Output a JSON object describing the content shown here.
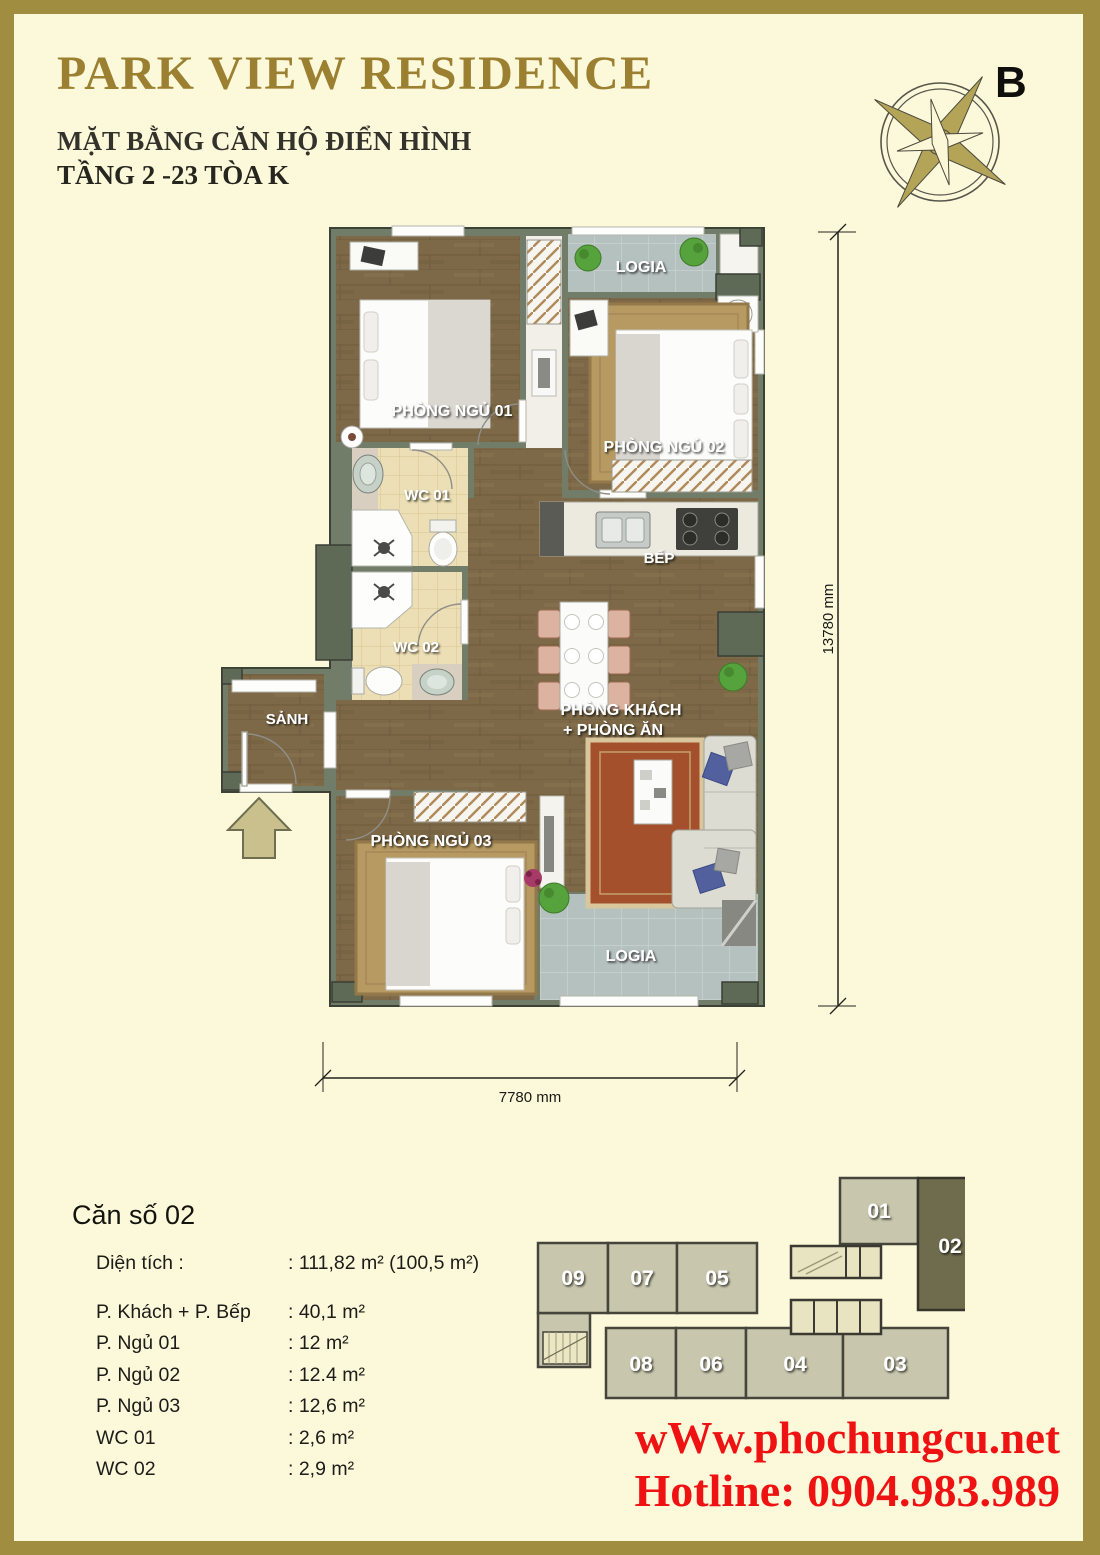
{
  "header": {
    "title": "PARK VIEW RESIDENCE",
    "subtitle1": "MẶT BẰNG CĂN HỘ ĐIỂN HÌNH",
    "subtitle2": "TẦNG 2 -23 TÒA K"
  },
  "compass": {
    "label": "B"
  },
  "plan": {
    "labels": {
      "bedroom1": "PHÒNG NGỦ 01",
      "logia_top": "LOGIA",
      "bedroom2": "PHÒNG NGỦ 02",
      "wc1": "WC 01",
      "kitchen": "BẾP",
      "wc2": "WC 02",
      "hall": "SẢNH",
      "living_line1": "PHÒNG KHÁCH",
      "living_line2": "+ PHÒNG ĂN",
      "bedroom3": "PHÒNG NGỦ 03",
      "logia_bottom": "LOGIA"
    },
    "dimensions": {
      "height": "13780 mm",
      "width": "7780 mm"
    }
  },
  "unit_info": {
    "title": "Căn số 02",
    "rows": [
      {
        "label": "Diện tích :",
        "value": ": 111,82 m² (100,5 m²)"
      },
      {
        "label": "P. Khách + P. Bếp",
        "value": ": 40,1 m²"
      },
      {
        "label": "P. Ngủ 01",
        "value": ": 12 m²"
      },
      {
        "label": "P. Ngủ 02",
        "value": ": 12.4 m²"
      },
      {
        "label": "P. Ngủ 03",
        "value": ": 12,6 m²"
      },
      {
        "label": "WC 01",
        "value": ": 2,6 m²"
      },
      {
        "label": "WC 02",
        "value": ": 2,9 m²"
      }
    ]
  },
  "key_plan": {
    "highlighted_unit": "02",
    "units": {
      "u01": "01",
      "u02": "02",
      "u03": "03",
      "u04": "04",
      "u05": "05",
      "u06": "06",
      "u07": "07",
      "u08": "08",
      "u09": "09"
    }
  },
  "footer": {
    "website": "wWw.phochungcu.net",
    "hotline": "Hotline: 0904.983.989"
  },
  "colors": {
    "frame_gold": "#a18d40",
    "title_gold": "#9c8031",
    "background": "#fcf8da",
    "wall": "#717c69",
    "wood_floor": "#7d6947",
    "wc_tile": "#ecdfb5",
    "logia_tile": "#b5c1bf",
    "keyplan_unit": "#c8c6ad",
    "keyplan_highlight": "#6e6c4d",
    "footer_red": "#ee1212"
  }
}
